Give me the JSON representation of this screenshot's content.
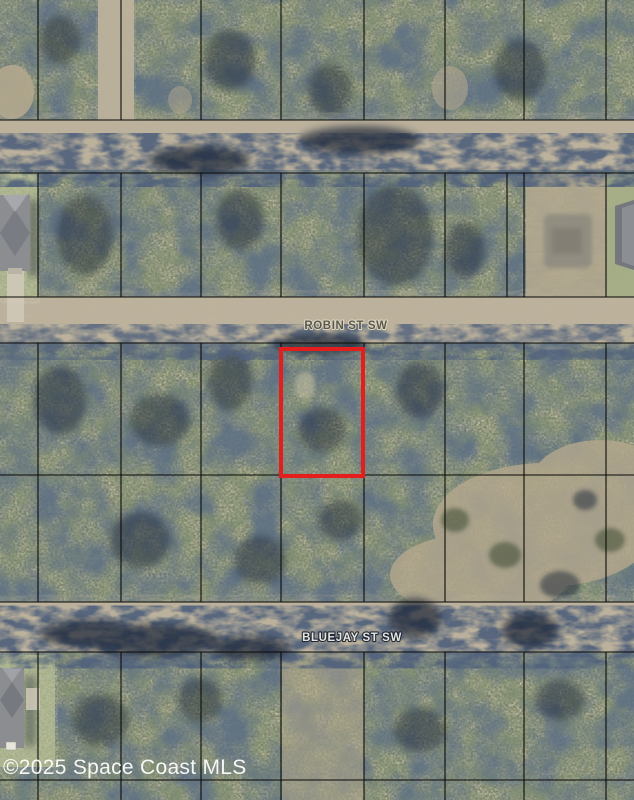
{
  "map": {
    "type": "aerial-parcel-map",
    "streets": [
      {
        "name": "ROBIN ST SW",
        "label_x": 346,
        "label_y": 329,
        "style": "dark"
      },
      {
        "name": "BLUEJAY ST SW",
        "label_x": 352,
        "label_y": 641,
        "style": "light"
      }
    ],
    "roads": [
      {
        "id": "unnamed-dirt-road",
        "y": 120,
        "height": 50
      },
      {
        "id": "robin-st-sw",
        "y": 297,
        "height": 46
      },
      {
        "id": "bluejay-st-sw",
        "y": 602,
        "height": 50
      }
    ],
    "grid": {
      "line_color": "rgba(14,14,10,0.82)",
      "horizontal_lines": [
        120,
        173,
        297,
        343,
        475,
        602,
        652,
        780
      ],
      "vertical_x": [
        38,
        121,
        201,
        281,
        364,
        445,
        524,
        606
      ],
      "bands": [
        {
          "y0": 0,
          "y1": 120
        },
        {
          "y0": 173,
          "y1": 297,
          "extra_x": [
            507
          ]
        },
        {
          "y0": 343,
          "y1": 602
        },
        {
          "y0": 652,
          "y1": 800
        }
      ]
    },
    "highlight_parcel": {
      "x": 281,
      "y": 349,
      "width": 82,
      "height": 127,
      "stroke": "#e31e1c",
      "stroke_width": 4
    },
    "colors": {
      "veg_base": "#7d8165",
      "veg_light": "#b3ba94",
      "veg_dark": "#33422a",
      "shadow_navy": "#1c2638",
      "road_tan": "#bdb29c",
      "sand": "#b3a78d",
      "roof_gray": "#8b8d90",
      "concrete": "#cfc9b8"
    }
  },
  "watermark": {
    "text": "©2025 Space Coast MLS",
    "color": "rgba(255,255,255,0.93)"
  }
}
